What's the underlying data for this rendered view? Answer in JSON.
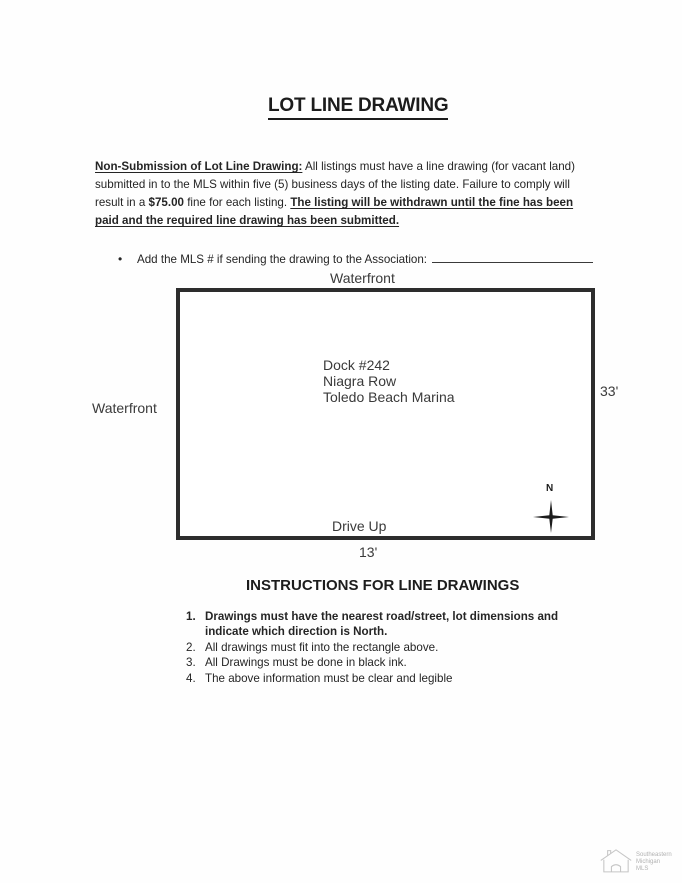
{
  "page": {
    "title": "LOT LINE DRAWING",
    "policy": {
      "label": "Non-Submission of Lot Line Drawing:",
      "body1": "  All listings must have a line drawing (for vacant land) submitted in to the MLS within five (5) business days of the listing date. Failure to comply will result in a ",
      "fine_amount": "$75.00",
      "body2": " fine for each listing. ",
      "warning": "The listing will be withdrawn until the fine has been paid and the required line drawing has been submitted."
    },
    "bullet": {
      "marker": "•",
      "text": "Add the MLS # if sending the drawing to the Association:"
    },
    "drawing": {
      "top_label": "Waterfront",
      "left_label": "Waterfront",
      "right_dimension": "33'",
      "bottom_label": "Drive Up",
      "bottom_dimension": "13'",
      "content_lines": [
        "Dock #242",
        "Niagra Row",
        "Toledo Beach Marina"
      ],
      "compass_label": "N"
    },
    "instructions": {
      "heading": "INSTRUCTIONS FOR LINE DRAWINGS",
      "items": [
        {
          "num": "1.",
          "text": "Drawings must have the nearest road/street, lot dimensions and indicate which direction is North."
        },
        {
          "num": "2.",
          "text": "All drawings must fit into the rectangle above."
        },
        {
          "num": "3.",
          "text": "All Drawings must be done in black ink."
        },
        {
          "num": "4.",
          "text": "The above information must be clear and legible"
        }
      ]
    },
    "watermark": {
      "lines": [
        "Southeastern",
        "Michigan",
        "MLS"
      ]
    }
  }
}
